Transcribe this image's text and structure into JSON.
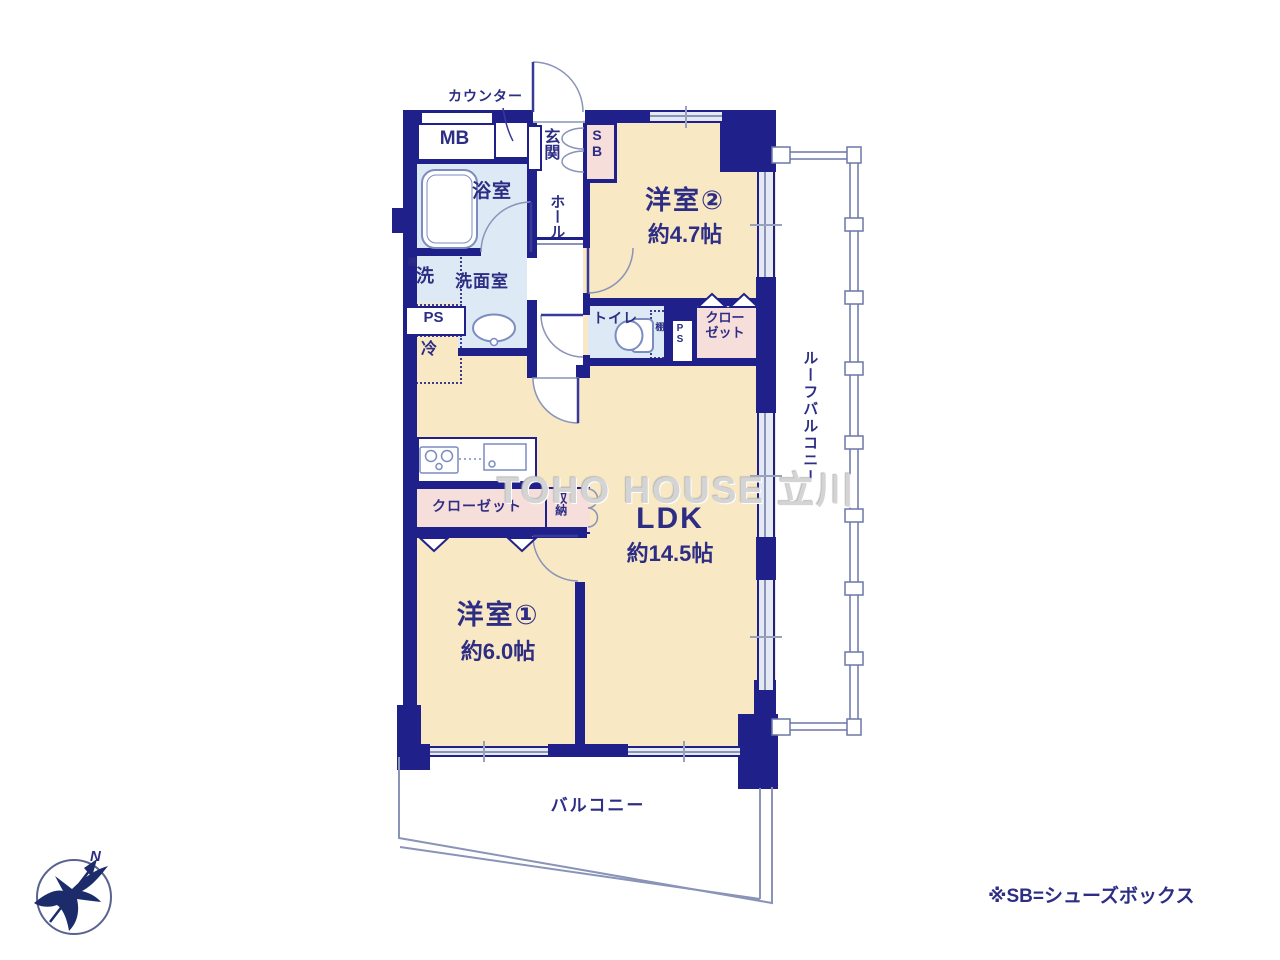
{
  "rooms": [
    {
      "name": "洋室②",
      "size": "約4.7帖"
    },
    {
      "name": "LDK",
      "size": "約14.5帖"
    },
    {
      "name": "洋室①",
      "size": "約6.0帖"
    }
  ],
  "labels": {
    "counter": "カウンター",
    "mb": "MB",
    "genkan": "玄関",
    "sb": "SB",
    "bath": "浴室",
    "hall": "ホール",
    "washer_small": "機",
    "washer": "洗",
    "washroom": "洗面室",
    "ps_left": "PS",
    "fridge": "冷",
    "toilet": "トイレ",
    "shelf": "棚",
    "ps_mid": "PS",
    "closet2_line1": "クロー",
    "closet2_line2": "ゼット",
    "roof_balcony": "ルーフバルコニー",
    "kitchen_closet": "クローゼット",
    "storage": "収納",
    "balcony": "バルコニー"
  },
  "note": "※SB=シューズボックス",
  "watermark": "TOHO HOUSE 立川",
  "compass": {
    "north": "N"
  },
  "colors": {
    "wall": "#20208a",
    "room_fill": "#f8e8c3",
    "wet_fill": "#dde9f4",
    "closet_fill": "#f6dedb",
    "text": "#2d2d84",
    "outline": "#8a93b8"
  }
}
